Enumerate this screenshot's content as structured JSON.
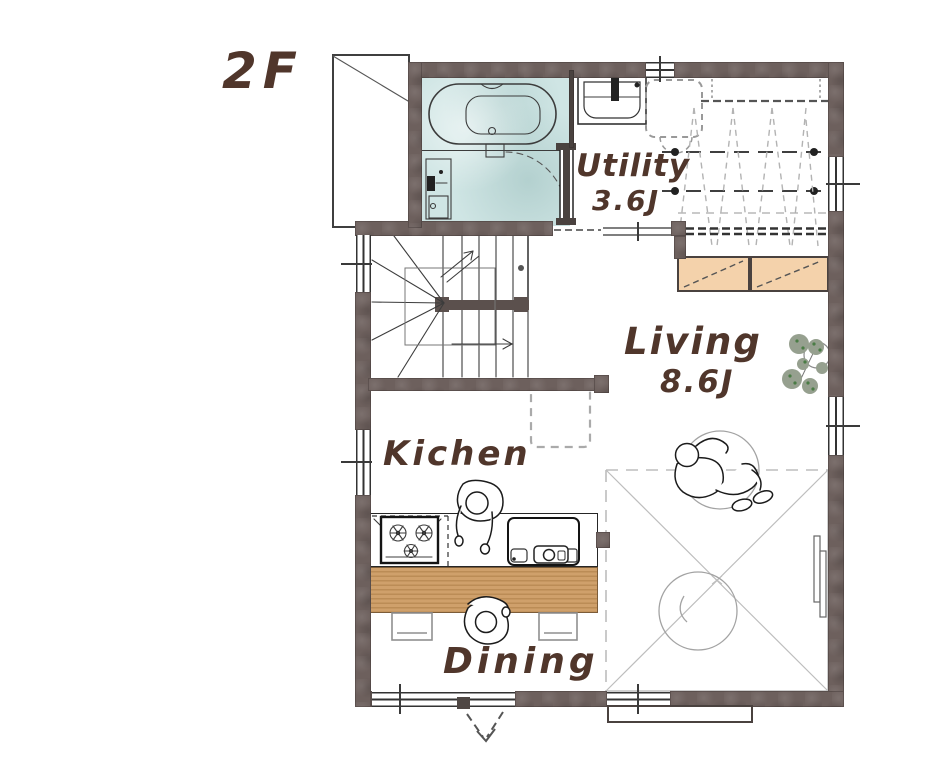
{
  "floor": {
    "label": "2F"
  },
  "rooms": {
    "utility": {
      "name": "Utility",
      "size": "3.6J"
    },
    "living": {
      "name": "Living",
      "size": "8.6J"
    },
    "kitchen": {
      "name": "Kichen"
    },
    "dining": {
      "name": "Dining"
    }
  },
  "colors": {
    "wall": "#6d605d",
    "wall_dark": "#4a423f",
    "bath": "#cfe5e4",
    "cabinet": "#f4d2ab",
    "wood": "#cfa06b",
    "wood_stripe": "#bb8c56",
    "ink": "#50362b",
    "plant": "#96a08f",
    "plant_dot": "#4a7c45"
  }
}
